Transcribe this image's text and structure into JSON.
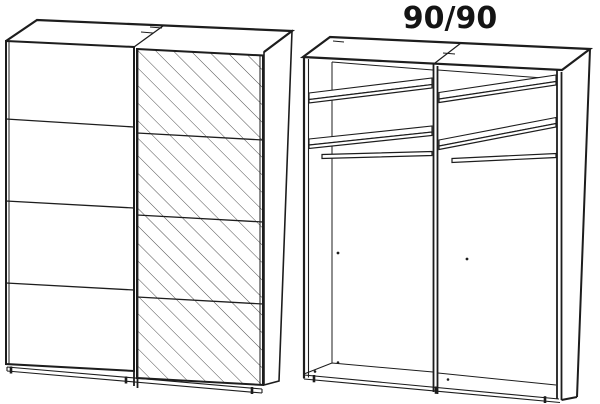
{
  "page": {
    "background_color": "#ffffff",
    "line_color": "#1d1d1d",
    "hatch_color": "#3a3a3a"
  },
  "annotation": {
    "dimension_label": "90/90"
  },
  "diagram": {
    "type": "wardrobe-assembly-drawing",
    "views": [
      {
        "name": "front-view-sliding-doors",
        "doors": [
          {
            "name": "left-sliding-door",
            "finish": "plain",
            "horizontal_divisions": 3
          },
          {
            "name": "right-sliding-door",
            "finish": "mirror-hatched",
            "horizontal_divisions": 3
          }
        ]
      },
      {
        "name": "interior-view",
        "dimension_label": "90/90",
        "compartments": [
          {
            "name": "left-compartment",
            "shelves": 2,
            "hanging_rail": true
          },
          {
            "name": "right-compartment",
            "shelves": 2,
            "hanging_rail": true
          }
        ]
      }
    ]
  }
}
